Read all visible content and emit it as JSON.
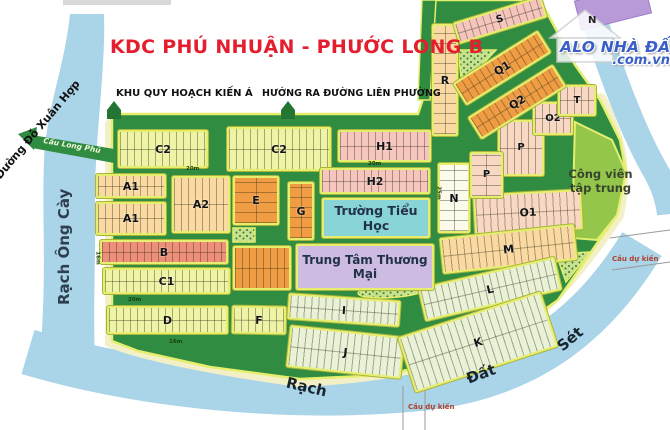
{
  "map": {
    "title": "KDC PHÚ NHUẬN - PHƯỚC LONG B",
    "annotations": {
      "khu_quy_hoach": "KHU QUY HOẠCH KIẾN Á",
      "huong_ra": "HƯỚNG RA ĐƯỜNG LIÊN PHƯỜNG",
      "duong_do_xuan_hop": "Đường Đỗ Xuân Hợp",
      "rach_ong_cay": "Rạch Ông Cày",
      "rach": "Rạch",
      "dat": "Đất",
      "set": "Sét",
      "cau_long_phu": "Cầu Long Phú",
      "cau_du_kien_bottom": "Cầu dự kiến",
      "cau_du_kien_right": "Cầu dự kiến",
      "compass_n": "N"
    },
    "logo": {
      "line1": "ALO NHÀ ĐẤT",
      "line2": ".com.vn"
    },
    "landmarks": {
      "school": "Trường Tiểu Học",
      "mall": "Trung Tâm Thương Mại",
      "park_line1": "Công viên",
      "park_line2": "tập trung"
    },
    "blocks": [
      {
        "id": "c2-west",
        "label": "C2",
        "x": 118,
        "y": 130,
        "w": 90,
        "h": 38,
        "rot": 0,
        "c": "yg"
      },
      {
        "id": "c2-east",
        "label": "C2",
        "x": 227,
        "y": 127,
        "w": 104,
        "h": 44,
        "rot": 0,
        "c": "yg"
      },
      {
        "id": "h1",
        "label": "H1",
        "x": 338,
        "y": 130,
        "w": 93,
        "h": 32,
        "rot": 0,
        "c": "pink"
      },
      {
        "id": "a1-north",
        "label": "A1",
        "x": 96,
        "y": 174,
        "w": 70,
        "h": 24,
        "rot": 0,
        "c": "peach"
      },
      {
        "id": "a1-south",
        "label": "A1",
        "x": 96,
        "y": 202,
        "w": 70,
        "h": 33,
        "rot": 0,
        "c": "peach"
      },
      {
        "id": "a2",
        "label": "A2",
        "x": 172,
        "y": 176,
        "w": 58,
        "h": 57,
        "rot": 0,
        "c": "peach"
      },
      {
        "id": "e",
        "label": "E",
        "x": 233,
        "y": 176,
        "w": 46,
        "h": 49,
        "rot": 0,
        "c": "orange",
        "col": true
      },
      {
        "id": "g",
        "label": "G",
        "x": 288,
        "y": 182,
        "w": 26,
        "h": 58,
        "rot": 0,
        "c": "orange",
        "col": true
      },
      {
        "id": "e2",
        "label": "",
        "x": 233,
        "y": 246,
        "w": 58,
        "h": 44,
        "rot": 0,
        "c": "orange"
      },
      {
        "id": "b",
        "label": "B",
        "x": 100,
        "y": 240,
        "w": 128,
        "h": 24,
        "rot": 0,
        "c": "salmon"
      },
      {
        "id": "c1",
        "label": "C1",
        "x": 103,
        "y": 268,
        "w": 127,
        "h": 26,
        "rot": 0,
        "c": "yg"
      },
      {
        "id": "d",
        "label": "D",
        "x": 107,
        "y": 306,
        "w": 121,
        "h": 28,
        "rot": 0,
        "c": "yg"
      },
      {
        "id": "f",
        "label": "F",
        "x": 232,
        "y": 306,
        "w": 54,
        "h": 28,
        "rot": 1,
        "c": "yg"
      },
      {
        "id": "h2",
        "label": "H2",
        "x": 320,
        "y": 168,
        "w": 110,
        "h": 26,
        "rot": 0,
        "c": "pink"
      },
      {
        "id": "n",
        "label": "N",
        "x": 438,
        "y": 163,
        "w": 32,
        "h": 70,
        "rot": 0,
        "c": "whiteb",
        "col": true
      },
      {
        "id": "o1",
        "label": "O1",
        "x": 474,
        "y": 192,
        "w": 108,
        "h": 40,
        "rot": -3,
        "c": "ppink"
      },
      {
        "id": "p-upper",
        "label": "P",
        "x": 498,
        "y": 120,
        "w": 46,
        "h": 56,
        "rot": 0,
        "c": "ppink",
        "fs": 10
      },
      {
        "id": "p-lower",
        "label": "P",
        "x": 470,
        "y": 152,
        "w": 33,
        "h": 46,
        "rot": 0,
        "c": "ppink",
        "fs": 10,
        "col": true
      },
      {
        "id": "o2",
        "label": "O2",
        "x": 533,
        "y": 102,
        "w": 40,
        "h": 33,
        "rot": 0,
        "c": "ppink",
        "fs": 10
      },
      {
        "id": "t",
        "label": "T",
        "x": 558,
        "y": 85,
        "w": 38,
        "h": 31,
        "rot": 0,
        "c": "ppink",
        "fs": 10
      },
      {
        "id": "r",
        "label": "R",
        "x": 432,
        "y": 24,
        "w": 26,
        "h": 112,
        "rot": 0,
        "c": "peach",
        "col": true
      },
      {
        "id": "s",
        "label": "S",
        "x": 454,
        "y": 9,
        "w": 92,
        "h": 22,
        "rot": -17,
        "c": "pink",
        "fs": 10
      },
      {
        "id": "q1",
        "label": "Q1",
        "x": 452,
        "y": 55,
        "w": 100,
        "h": 26,
        "rot": -32,
        "c": "orange"
      },
      {
        "id": "q2",
        "label": "Q2",
        "x": 467,
        "y": 89,
        "w": 100,
        "h": 26,
        "rot": -32,
        "c": "orange"
      },
      {
        "id": "m",
        "label": "M",
        "x": 441,
        "y": 231,
        "w": 135,
        "h": 36,
        "rot": -6,
        "c": "peach"
      },
      {
        "id": "l",
        "label": "L",
        "x": 420,
        "y": 272,
        "w": 140,
        "h": 34,
        "rot": -13,
        "c": "lgreen"
      },
      {
        "id": "i",
        "label": "I",
        "x": 288,
        "y": 297,
        "w": 112,
        "h": 26,
        "rot": 4,
        "c": "lgreen"
      },
      {
        "id": "j",
        "label": "J",
        "x": 288,
        "y": 331,
        "w": 115,
        "h": 42,
        "rot": 6,
        "c": "lgreen"
      },
      {
        "id": "k",
        "label": "K",
        "x": 403,
        "y": 313,
        "w": 150,
        "h": 58,
        "rot": -18,
        "c": "lgreen"
      }
    ],
    "road_markers": [
      {
        "t": "20m",
        "x": 186,
        "y": 166,
        "rot": 0
      },
      {
        "t": "20m",
        "x": 368,
        "y": 161,
        "rot": 0
      },
      {
        "t": "20m",
        "x": 128,
        "y": 297,
        "rot": 0
      },
      {
        "t": "16m",
        "x": 169,
        "y": 339,
        "rot": 0
      },
      {
        "t": "25m",
        "x": 432,
        "y": 190,
        "rot": 90
      },
      {
        "t": "16m",
        "x": 91,
        "y": 255,
        "rot": 90
      }
    ],
    "colors": {
      "road_green": "#2f8c41",
      "water_blue": "#aad4e8",
      "shore_pale": "#f3f0c8",
      "block_border_yellow": "#e6ee6e",
      "title_red": "#e41e2e",
      "logo_blue": "#3a5fc6",
      "park_green": "#93c64a",
      "building_purple": "#b89ad8"
    }
  }
}
